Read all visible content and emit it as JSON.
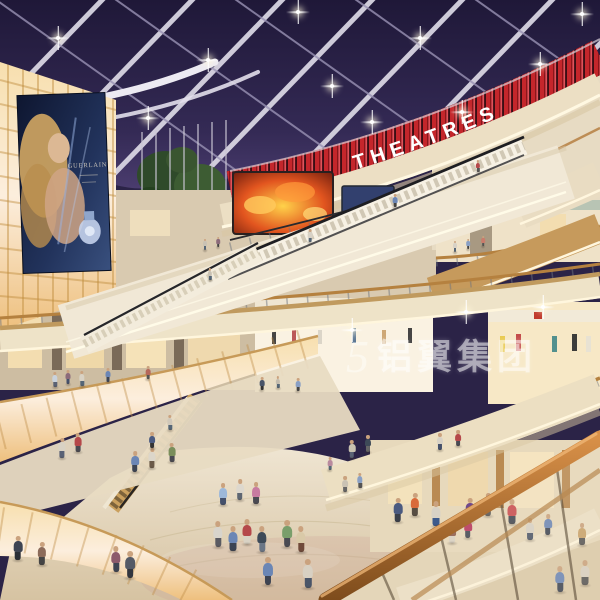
{
  "scene": {
    "kind": "shopping-mall-atrium-architectural-rendering",
    "signs": {
      "theatre": "THEATRES"
    },
    "billboard": {
      "brand": "GUERLAIN"
    },
    "watermark": {
      "logo": "5",
      "text": "铝翼集团"
    },
    "palette": {
      "sky": "#2b2347",
      "red_sign": "#c4262b",
      "cream": "#ecdfc4",
      "wood": "#b5813f",
      "glow_panel": "#f7dfae",
      "floor": "#e3d4b6",
      "fire_screen": "#e2551f"
    },
    "starbursts": [
      [
        58,
        38
      ],
      [
        148,
        118
      ],
      [
        208,
        60
      ],
      [
        298,
        12
      ],
      [
        332,
        86
      ],
      [
        420,
        38
      ],
      [
        462,
        112
      ],
      [
        540,
        64
      ],
      [
        582,
        14
      ],
      [
        372,
        122
      ],
      [
        543,
        307
      ],
      [
        466,
        312
      ],
      [
        352,
        330
      ]
    ],
    "people": [
      [
        218,
        547,
        26,
        "#d8d4cc",
        "#5a5a62"
      ],
      [
        233,
        551,
        25,
        "#6b86b5",
        "#3c4454"
      ],
      [
        247,
        544,
        25,
        "#b5484a",
        "#d9d2c4"
      ],
      [
        262,
        552,
        26,
        "#3e4a58",
        "#6b7686"
      ],
      [
        287,
        547,
        27,
        "#7a9e6b",
        "#4a4a52"
      ],
      [
        301,
        552,
        26,
        "#d9c9a8",
        "#704a3a"
      ],
      [
        223,
        505,
        22,
        "#9db8d9",
        "#44506b"
      ],
      [
        240,
        500,
        21,
        "#ddd8ce",
        "#5e6672"
      ],
      [
        256,
        504,
        22,
        "#c87ba0",
        "#4a4a52"
      ],
      [
        398,
        522,
        24,
        "#4a5a80",
        "#3a3f4a"
      ],
      [
        415,
        516,
        23,
        "#d96a3a",
        "#574d42"
      ],
      [
        436,
        526,
        25,
        "#d8d2c6",
        "#3c5a8c"
      ],
      [
        470,
        522,
        24,
        "#704a8c",
        "#3f3f48"
      ],
      [
        488,
        516,
        23,
        "#3c5a8c",
        "#555555"
      ],
      [
        512,
        524,
        25,
        "#c94a4e",
        "#3e4450"
      ],
      [
        345,
        492,
        16,
        "#c9c2b4",
        "#666666"
      ],
      [
        360,
        488,
        15,
        "#8aa0c4",
        "#555555"
      ],
      [
        330,
        470,
        13,
        "#b98a9e",
        "#556677"
      ],
      [
        268,
        585,
        28,
        "#6b86b5",
        "#3e4452"
      ],
      [
        308,
        588,
        29,
        "#d8d0c2",
        "#4a5568"
      ],
      [
        130,
        578,
        27,
        "#555a66",
        "#33363e"
      ],
      [
        116,
        572,
        26,
        "#8c5a6b",
        "#3e4452"
      ],
      [
        62,
        458,
        20,
        "#d9d2c4",
        "#5a6275"
      ],
      [
        78,
        452,
        19,
        "#b5484a",
        "#4a4a52"
      ],
      [
        135,
        472,
        21,
        "#6b86b5",
        "#3c4454"
      ],
      [
        152,
        468,
        20,
        "#dcd6ca",
        "#6b5a48"
      ],
      [
        172,
        462,
        19,
        "#7a8e5b",
        "#4a4a52"
      ],
      [
        55,
        387,
        15,
        "#c9d2dc",
        "#5a6275"
      ],
      [
        68,
        384,
        14,
        "#8c6b7a",
        "#44506b"
      ],
      [
        82,
        386,
        15,
        "#d9d2c4",
        "#556677"
      ],
      [
        108,
        382,
        14,
        "#6b86b5",
        "#3c4454"
      ],
      [
        148,
        379,
        13,
        "#b5685a",
        "#555555"
      ],
      [
        262,
        390,
        13,
        "#4a5568",
        "#333333"
      ],
      [
        278,
        388,
        12,
        "#c4bcae",
        "#556677"
      ],
      [
        298,
        391,
        13,
        "#8aa0c4",
        "#444444"
      ],
      [
        352,
        458,
        18,
        "#c9c2b0",
        "#5a6275"
      ],
      [
        368,
        452,
        17,
        "#3e4a58",
        "#666666"
      ],
      [
        440,
        450,
        17,
        "#d8d2c6",
        "#44506b"
      ],
      [
        458,
        446,
        16,
        "#b5484a",
        "#4a4a52"
      ],
      [
        452,
        543,
        22,
        "#8c5a4a",
        "#d9d2c4"
      ],
      [
        468,
        538,
        21,
        "#b5325a",
        "#3e4452"
      ],
      [
        530,
        540,
        22,
        "#d8d2c6",
        "#4a5568"
      ],
      [
        548,
        535,
        21,
        "#6b86b5",
        "#3c4454"
      ],
      [
        582,
        545,
        22,
        "#c9a26b",
        "#555555"
      ],
      [
        455,
        252,
        11,
        "#d8d2c6",
        "#556677"
      ],
      [
        468,
        249,
        10,
        "#8aa0c4",
        "#444444"
      ],
      [
        483,
        246,
        10,
        "#c97b6b",
        "#555555"
      ],
      [
        205,
        250,
        11,
        "#c9c2b4",
        "#556677"
      ],
      [
        218,
        247,
        10,
        "#8c6b7a",
        "#444444"
      ],
      [
        310,
        242,
        13,
        "#d8d2c6",
        "#556677"
      ],
      [
        395,
        207,
        13,
        "#6b86b5",
        "#444444"
      ],
      [
        478,
        172,
        12,
        "#b5484a",
        "#555555"
      ],
      [
        210,
        280,
        12,
        "#c9c2b4",
        "#556677"
      ],
      [
        152,
        448,
        16,
        "#4a5a80",
        "#333333"
      ],
      [
        170,
        430,
        15,
        "#d0c8ba",
        "#556677"
      ],
      [
        18,
        560,
        24,
        "#3e4452",
        "#2a2e36"
      ],
      [
        42,
        565,
        23,
        "#8c6b5a",
        "#444444"
      ],
      [
        560,
        592,
        26,
        "#6b86b5",
        "#3c4454"
      ],
      [
        585,
        585,
        25,
        "#d8d0c2",
        "#555555"
      ]
    ]
  }
}
